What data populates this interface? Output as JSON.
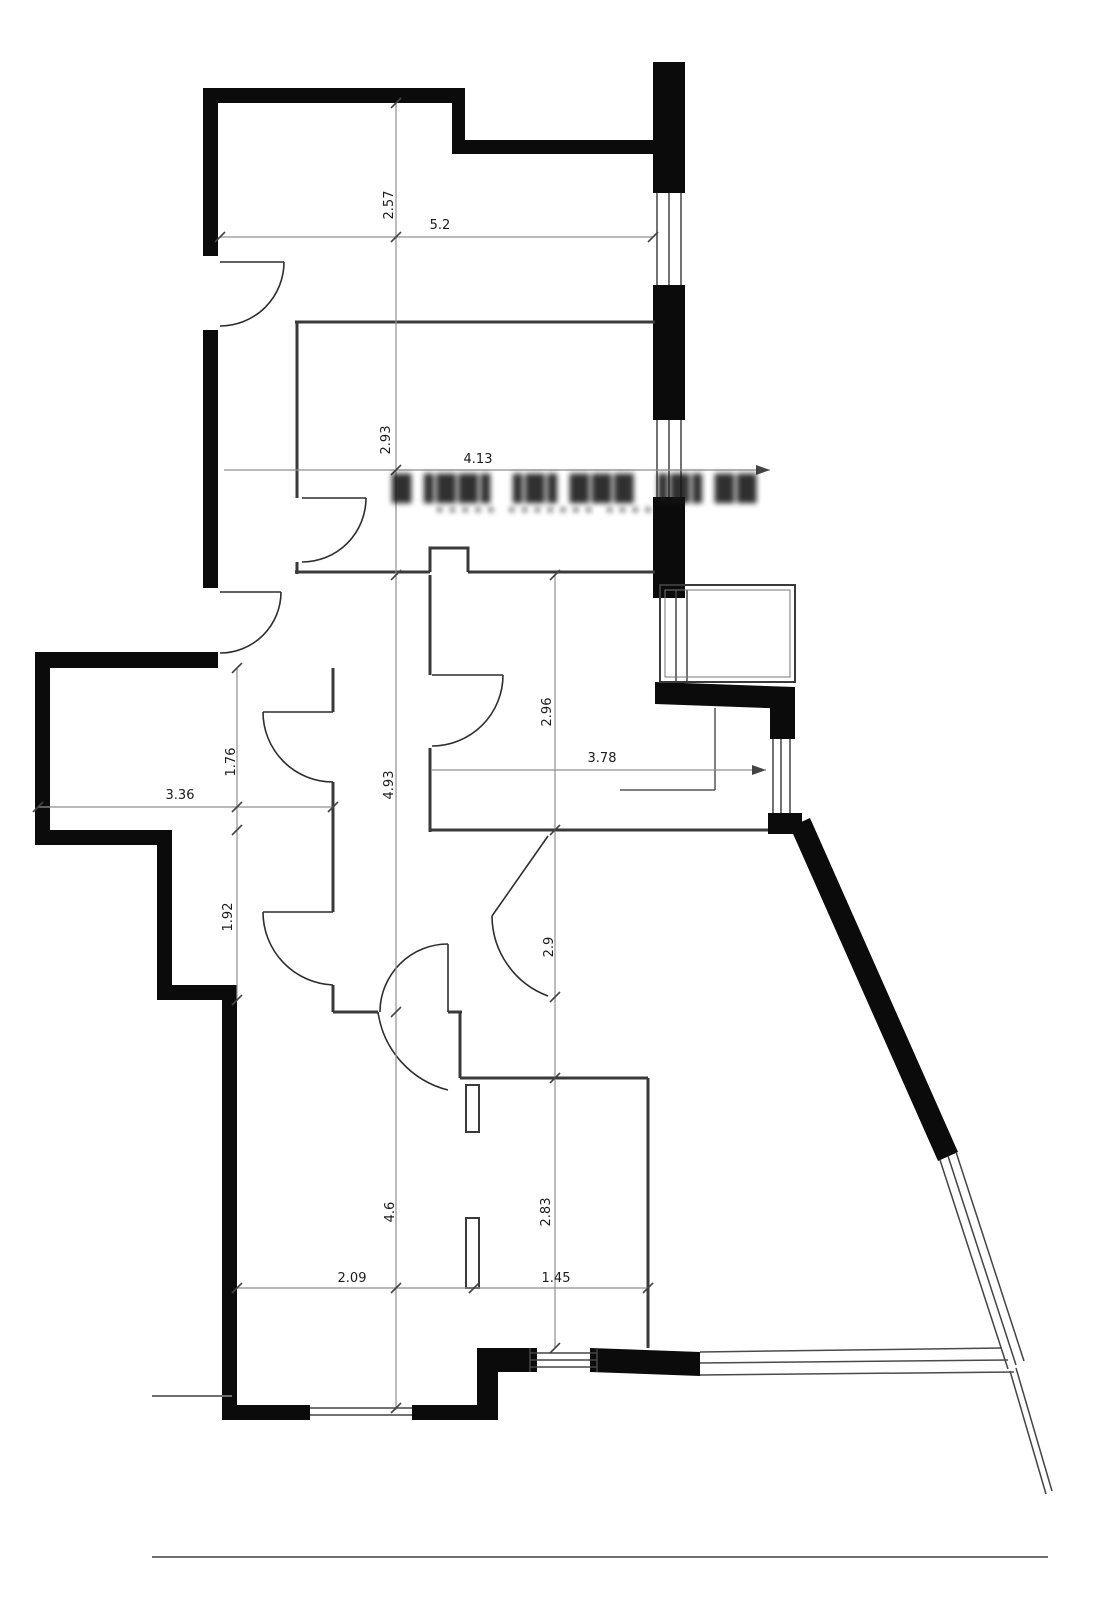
{
  "drawing": {
    "type": "apartment-floor-plan",
    "units": "m"
  },
  "watermark": {
    "line1": "█▐██▌▐█▌███ ▐█▌██",
    "line2": "▪▪▪▪▪ ▪▪▪▪▪▪▪ ▪▪▪▪"
  },
  "dims": {
    "d257": "2.57",
    "d52": "5.2",
    "d293": "2.93",
    "d413": "4.13",
    "d296": "2.96",
    "d378": "3.78",
    "d176": "1.76",
    "d336": "3.36",
    "d493": "4.93",
    "d192": "1.92",
    "d29": "2.9",
    "d46": "4.6",
    "d283": "2.83",
    "d209": "2.09",
    "d145": "1.45"
  }
}
